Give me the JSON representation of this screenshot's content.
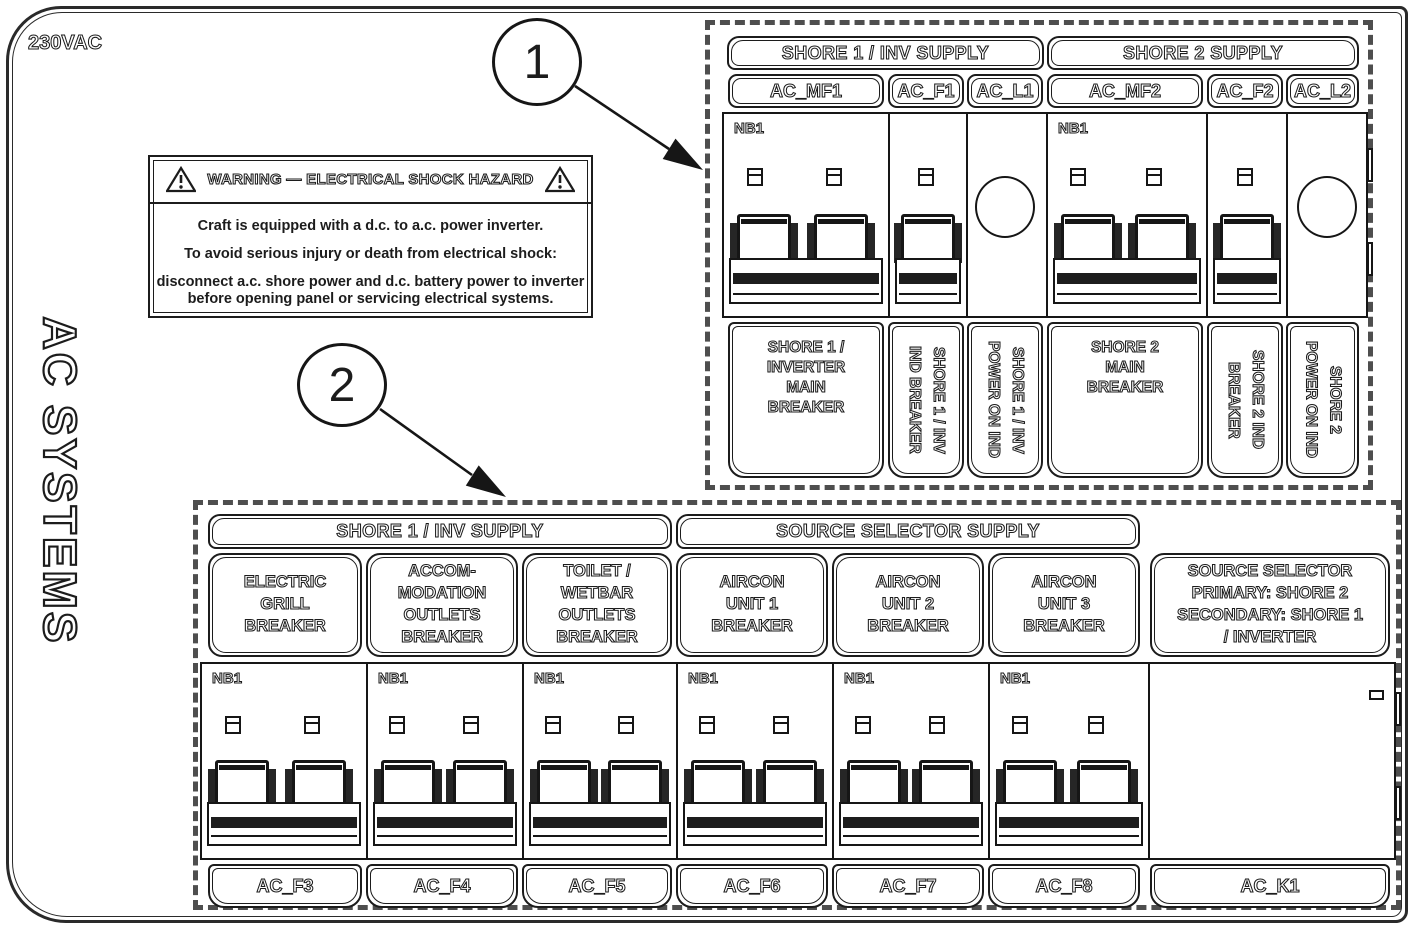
{
  "frame": {
    "voltage_label": "230VAC",
    "side_title": "AC SYSTEMS"
  },
  "warning": {
    "title": "WARNING — ELECTRICAL SHOCK HAZARD",
    "line1": "Craft is equipped with a d.c. to a.c. power inverter.",
    "line2": "To avoid serious injury or death from electrical shock:",
    "line3": "disconnect a.c. shore power and d.c. battery power to inverter\nbefore opening panel or servicing electrical systems."
  },
  "callouts": {
    "one": "1",
    "two": "2"
  },
  "shore_panel": {
    "groups": [
      "SHORE 1 / INV SUPPLY",
      "SHORE 2 SUPPLY"
    ],
    "module_label": "NB1",
    "tags": [
      "AC_MF1",
      "AC_F1",
      "AC_L1",
      "AC_MF2",
      "AC_F2",
      "AC_L2"
    ],
    "descriptions": [
      "SHORE 1 /\nINVERTER\nMAIN\nBREAKER",
      "SHORE 1 / INV\nIND BREAKER",
      "SHORE 1 / INV\nPOWER ON IND",
      "SHORE 2\nMAIN\nBREAKER",
      "SHORE 2 IND\nBREAKER",
      "SHORE 2\nPOWER ON IND"
    ]
  },
  "distribution_panel": {
    "groups": [
      "SHORE 1 / INV SUPPLY",
      "SOURCE SELECTOR SUPPLY"
    ],
    "module_label": "NB1",
    "names": [
      "ELECTRIC\nGRILL\nBREAKER",
      "ACCOM-\nMODATION\nOUTLETS\nBREAKER",
      "TOILET /\nWETBAR\nOUTLETS\nBREAKER",
      "AIRCON\nUNIT 1\nBREAKER",
      "AIRCON\nUNIT 2\nBREAKER",
      "AIRCON\nUNIT 3\nBREAKER",
      "SOURCE SELECTOR\nPRIMARY: SHORE 2\nSECONDARY: SHORE 1\n/ INVERTER"
    ],
    "tags": [
      "AC_F3",
      "AC_F4",
      "AC_F5",
      "AC_F6",
      "AC_F7",
      "AC_F8",
      "AC_K1"
    ]
  }
}
